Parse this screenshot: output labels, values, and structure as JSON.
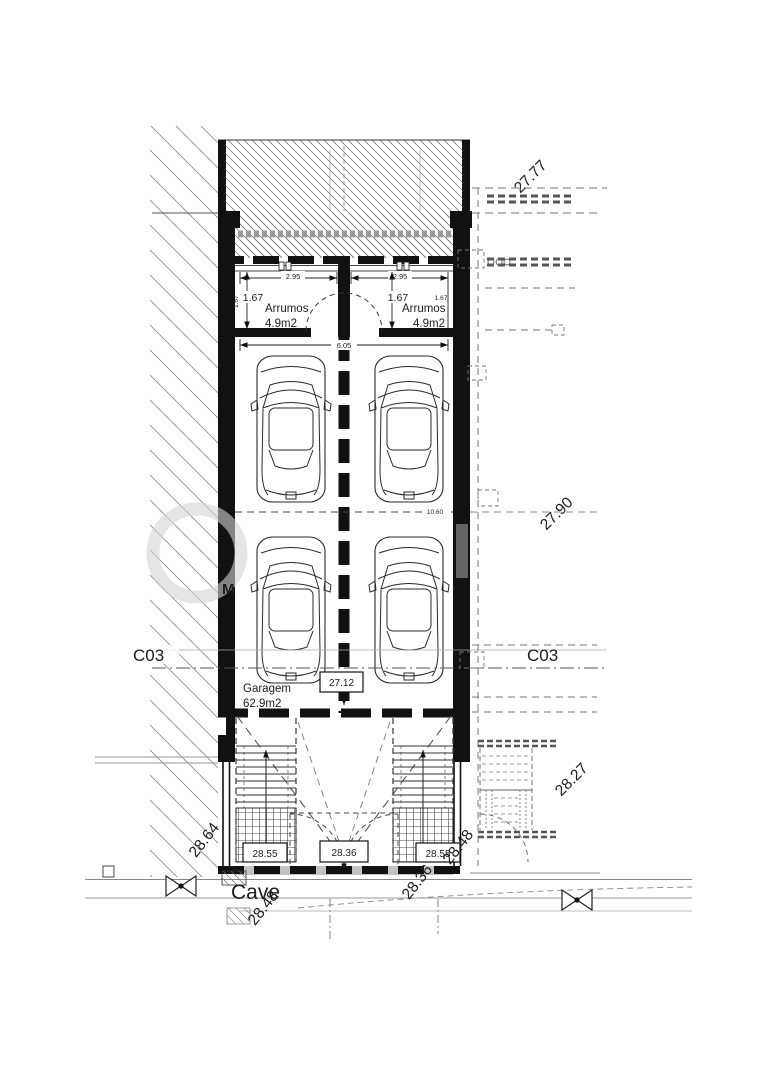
{
  "colors": {
    "paper": "#ffffff",
    "ink": "#1a1a1a",
    "wall_black": "#111111",
    "line_gray": "#777777",
    "light_gray": "#aaaaaa",
    "watermark_gray": "#c9c9c9"
  },
  "plan": {
    "floor_label": "Cave",
    "watermark_letter": "M",
    "section_marks": {
      "left": "C03",
      "right": "C03"
    },
    "levels": {
      "rear_yard": "27.77",
      "right_mid": "27.90",
      "garage_floor": "27.12",
      "entry_left": "28.55",
      "entry_center": "28.36",
      "entry_right": "28.55",
      "street_far_left": "28.64",
      "street_left": "28.48",
      "street_center": "28.36",
      "street_right": "28.48",
      "street_far_right": "28.27"
    },
    "rooms": {
      "storage_left_name": "Arrumos",
      "storage_left_area": "4.9m2",
      "storage_right_name": "Arrumos",
      "storage_right_area": "4.9m2",
      "garage_name": "Garagem",
      "garage_area": "62.9m2"
    },
    "dims": {
      "storage_left_width": "2.95",
      "storage_right_width": "2.95",
      "storage_left_depth": "1.67",
      "storage_left_depth_small": "1.67",
      "storage_right_depth": "1.67",
      "storage_right_depth_small": "1.67",
      "overall_width": "6.05",
      "garage_depth": "10.60"
    }
  }
}
